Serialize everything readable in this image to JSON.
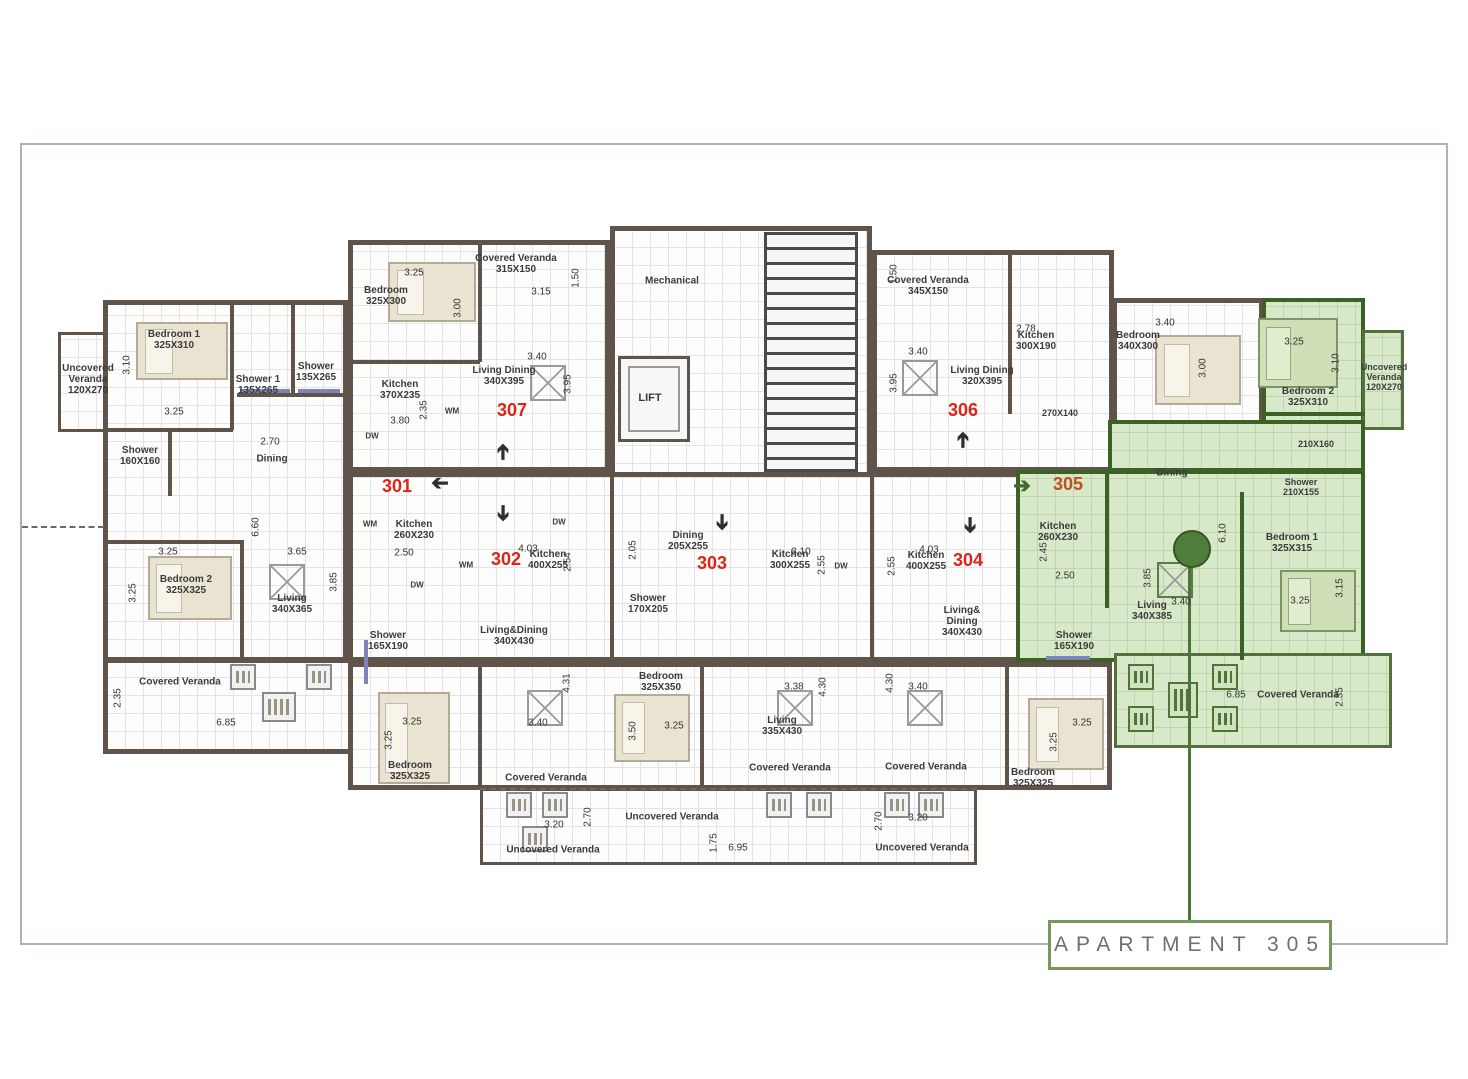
{
  "meta": {
    "drawing_type": "apartment floor plan",
    "highlighted_apartment": "305",
    "apartments_visible": [
      "301",
      "302",
      "303",
      "304",
      "305",
      "306",
      "307"
    ]
  },
  "colors": {
    "wall": "#60544a",
    "green_wall": "#3c6124",
    "green_fill": "#d8e9ca",
    "apartment_number_red": "#de2417",
    "apartment_number_305": "#bf4e20",
    "leader_green": "#4c7637",
    "frame": "#a9b6a8",
    "title_box_border": "#77975f",
    "title_box_text": "#6f6f6f"
  },
  "title_box": {
    "label": "APARTMENT 305"
  },
  "labels": [
    {
      "t": "Uncovered\nVeranda\n120X270",
      "x": 88,
      "y": 380,
      "k": "room"
    },
    {
      "t": "Bedroom 1\n325X310",
      "x": 174,
      "y": 340,
      "k": "room"
    },
    {
      "t": "Shower 1\n135X265",
      "x": 258,
      "y": 385,
      "k": "room"
    },
    {
      "t": "Shower\n135X265",
      "x": 316,
      "y": 372,
      "k": "room"
    },
    {
      "t": "Kitchen\n370X235",
      "x": 400,
      "y": 390,
      "k": "room"
    },
    {
      "t": "Shower\n160X160",
      "x": 140,
      "y": 456,
      "k": "room"
    },
    {
      "t": "Dining",
      "x": 272,
      "y": 459,
      "k": "room"
    },
    {
      "t": "Kitchen\n260X230",
      "x": 414,
      "y": 530,
      "k": "room"
    },
    {
      "t": "Living\n340X365",
      "x": 292,
      "y": 604,
      "k": "room"
    },
    {
      "t": "Bedroom 2\n325X325",
      "x": 186,
      "y": 585,
      "k": "room"
    },
    {
      "t": "Covered Veranda",
      "x": 180,
      "y": 682,
      "k": "room"
    },
    {
      "t": "Bedroom\n325X300",
      "x": 386,
      "y": 296,
      "k": "room"
    },
    {
      "t": "Covered Veranda\n315X150",
      "x": 516,
      "y": 264,
      "k": "room"
    },
    {
      "t": "Living Dining\n340X395",
      "x": 504,
      "y": 376,
      "k": "room"
    },
    {
      "t": "Mechanical",
      "x": 672,
      "y": 281,
      "k": "room"
    },
    {
      "t": "LIFT",
      "x": 650,
      "y": 398,
      "k": "room",
      "s": 11
    },
    {
      "t": "Covered Veranda\n345X150",
      "x": 928,
      "y": 286,
      "k": "room"
    },
    {
      "t": "Living Dining\n320X395",
      "x": 982,
      "y": 376,
      "k": "room"
    },
    {
      "t": "Kitchen\n300X190",
      "x": 1036,
      "y": 341,
      "k": "room"
    },
    {
      "t": "270X140",
      "x": 1060,
      "y": 413,
      "k": "room",
      "s": 9
    },
    {
      "t": "Bedroom\n340X300",
      "x": 1138,
      "y": 341,
      "k": "room"
    },
    {
      "t": "Bedroom 2\n325X310",
      "x": 1308,
      "y": 397,
      "k": "room"
    },
    {
      "t": "Uncovered\nVeranda\n120X270",
      "x": 1384,
      "y": 377,
      "k": "room",
      "s": 9
    },
    {
      "t": "210X160",
      "x": 1316,
      "y": 444,
      "k": "room",
      "s": 9
    },
    {
      "t": "Dining",
      "x": 1172,
      "y": 473,
      "k": "room"
    },
    {
      "t": "Shower\n210X155",
      "x": 1301,
      "y": 487,
      "k": "room",
      "s": 9
    },
    {
      "t": "Bedroom 1\n325X315",
      "x": 1292,
      "y": 543,
      "k": "room"
    },
    {
      "t": "Kitchen\n260X230",
      "x": 1058,
      "y": 532,
      "k": "room"
    },
    {
      "t": "Living\n340X385",
      "x": 1152,
      "y": 611,
      "k": "room"
    },
    {
      "t": "Covered Veranda",
      "x": 1298,
      "y": 695,
      "k": "room"
    },
    {
      "t": "Kitchen\n400X255",
      "x": 548,
      "y": 560,
      "k": "room"
    },
    {
      "t": "Living&Dining\n340X430",
      "x": 514,
      "y": 636,
      "k": "room"
    },
    {
      "t": "Shower\n165X190",
      "x": 388,
      "y": 641,
      "k": "room"
    },
    {
      "t": "Bedroom\n325X325",
      "x": 410,
      "y": 771,
      "k": "room"
    },
    {
      "t": "Covered Veranda",
      "x": 546,
      "y": 778,
      "k": "room"
    },
    {
      "t": "Uncovered Veranda",
      "x": 553,
      "y": 850,
      "k": "room"
    },
    {
      "t": "Dining\n205X255",
      "x": 688,
      "y": 541,
      "k": "room"
    },
    {
      "t": "Shower\n170X205",
      "x": 648,
      "y": 604,
      "k": "room"
    },
    {
      "t": "Bedroom\n325X350",
      "x": 661,
      "y": 682,
      "k": "room"
    },
    {
      "t": "Kitchen\n300X255",
      "x": 790,
      "y": 560,
      "k": "room"
    },
    {
      "t": "Living\n335X430",
      "x": 782,
      "y": 726,
      "k": "room"
    },
    {
      "t": "Covered Veranda",
      "x": 790,
      "y": 768,
      "k": "room"
    },
    {
      "t": "Uncovered Veranda",
      "x": 672,
      "y": 817,
      "k": "room"
    },
    {
      "t": "Kitchen\n400X255",
      "x": 926,
      "y": 561,
      "k": "room"
    },
    {
      "t": "Living&\nDining\n340X430",
      "x": 962,
      "y": 622,
      "k": "room"
    },
    {
      "t": "Shower\n165X190",
      "x": 1074,
      "y": 641,
      "k": "room"
    },
    {
      "t": "Bedroom\n325X325",
      "x": 1033,
      "y": 778,
      "k": "room"
    },
    {
      "t": "Covered Veranda",
      "x": 926,
      "y": 767,
      "k": "room"
    },
    {
      "t": "Uncovered Veranda",
      "x": 922,
      "y": 848,
      "k": "room"
    },
    {
      "t": "3.10",
      "x": 127,
      "y": 365,
      "k": "dim",
      "r": 1
    },
    {
      "t": "3.25",
      "x": 174,
      "y": 412,
      "k": "dim"
    },
    {
      "t": "3.80",
      "x": 400,
      "y": 421,
      "k": "dim"
    },
    {
      "t": "2.35",
      "x": 424,
      "y": 410,
      "k": "dim",
      "r": 1
    },
    {
      "t": "2.70",
      "x": 270,
      "y": 442,
      "k": "dim"
    },
    {
      "t": "2.50",
      "x": 404,
      "y": 553,
      "k": "dim"
    },
    {
      "t": "3.65",
      "x": 297,
      "y": 552,
      "k": "dim"
    },
    {
      "t": "6.60",
      "x": 256,
      "y": 527,
      "k": "dim",
      "r": 1
    },
    {
      "t": "3.85",
      "x": 334,
      "y": 582,
      "k": "dim",
      "r": 1
    },
    {
      "t": "3.25",
      "x": 133,
      "y": 593,
      "k": "dim",
      "r": 1
    },
    {
      "t": "3.25",
      "x": 168,
      "y": 552,
      "k": "dim"
    },
    {
      "t": "2.35",
      "x": 118,
      "y": 698,
      "k": "dim",
      "r": 1
    },
    {
      "t": "6.85",
      "x": 226,
      "y": 723,
      "k": "dim"
    },
    {
      "t": "3.25",
      "x": 414,
      "y": 273,
      "k": "dim"
    },
    {
      "t": "3.00",
      "x": 458,
      "y": 308,
      "k": "dim",
      "r": 1
    },
    {
      "t": "3.15",
      "x": 541,
      "y": 292,
      "k": "dim"
    },
    {
      "t": "1.50",
      "x": 576,
      "y": 278,
      "k": "dim",
      "r": 1
    },
    {
      "t": "3.40",
      "x": 537,
      "y": 357,
      "k": "dim"
    },
    {
      "t": "3.95",
      "x": 568,
      "y": 384,
      "k": "dim",
      "r": 1
    },
    {
      "t": "1.50",
      "x": 894,
      "y": 274,
      "k": "dim",
      "r": 1
    },
    {
      "t": "3.40",
      "x": 918,
      "y": 352,
      "k": "dim"
    },
    {
      "t": "3.95",
      "x": 894,
      "y": 383,
      "k": "dim",
      "r": 1
    },
    {
      "t": "2.78",
      "x": 1026,
      "y": 329,
      "k": "dim"
    },
    {
      "t": "3.40",
      "x": 1165,
      "y": 323,
      "k": "dim"
    },
    {
      "t": "3.00",
      "x": 1203,
      "y": 368,
      "k": "dim",
      "r": 1
    },
    {
      "t": "3.25",
      "x": 1294,
      "y": 342,
      "k": "dim"
    },
    {
      "t": "3.10",
      "x": 1336,
      "y": 363,
      "k": "dim",
      "r": 1
    },
    {
      "t": "6.10",
      "x": 1223,
      "y": 533,
      "k": "dim",
      "r": 1
    },
    {
      "t": "3.25",
      "x": 1300,
      "y": 601,
      "k": "dim"
    },
    {
      "t": "3.15",
      "x": 1340,
      "y": 588,
      "k": "dim",
      "r": 1
    },
    {
      "t": "2.45",
      "x": 1044,
      "y": 552,
      "k": "dim",
      "r": 1
    },
    {
      "t": "2.50",
      "x": 1065,
      "y": 576,
      "k": "dim"
    },
    {
      "t": "3.40",
      "x": 1181,
      "y": 602,
      "k": "dim"
    },
    {
      "t": "3.85",
      "x": 1148,
      "y": 578,
      "k": "dim",
      "r": 1
    },
    {
      "t": "6.85",
      "x": 1236,
      "y": 695,
      "k": "dim"
    },
    {
      "t": "2.35",
      "x": 1340,
      "y": 697,
      "k": "dim",
      "r": 1
    },
    {
      "t": "4.03",
      "x": 528,
      "y": 549,
      "k": "dim"
    },
    {
      "t": "2.54",
      "x": 568,
      "y": 562,
      "k": "dim",
      "r": 1
    },
    {
      "t": "4.31",
      "x": 567,
      "y": 683,
      "k": "dim",
      "r": 1
    },
    {
      "t": "3.40",
      "x": 538,
      "y": 723,
      "k": "dim"
    },
    {
      "t": "3.25",
      "x": 412,
      "y": 722,
      "k": "dim"
    },
    {
      "t": "3.25",
      "x": 389,
      "y": 740,
      "k": "dim",
      "r": 1
    },
    {
      "t": "3.20",
      "x": 554,
      "y": 825,
      "k": "dim"
    },
    {
      "t": "2.70",
      "x": 588,
      "y": 817,
      "k": "dim",
      "r": 1
    },
    {
      "t": "2.05",
      "x": 633,
      "y": 550,
      "k": "dim",
      "r": 1
    },
    {
      "t": "3.25",
      "x": 674,
      "y": 726,
      "k": "dim"
    },
    {
      "t": "3.50",
      "x": 633,
      "y": 731,
      "k": "dim",
      "r": 1
    },
    {
      "t": "3.10",
      "x": 801,
      "y": 552,
      "k": "dim"
    },
    {
      "t": "2.55",
      "x": 822,
      "y": 565,
      "k": "dim",
      "r": 1
    },
    {
      "t": "3.38",
      "x": 794,
      "y": 687,
      "k": "dim"
    },
    {
      "t": "4.30",
      "x": 823,
      "y": 687,
      "k": "dim",
      "r": 1
    },
    {
      "t": "4.03",
      "x": 929,
      "y": 550,
      "k": "dim"
    },
    {
      "t": "2.55",
      "x": 892,
      "y": 566,
      "k": "dim",
      "r": 1
    },
    {
      "t": "3.40",
      "x": 918,
      "y": 687,
      "k": "dim"
    },
    {
      "t": "4.30",
      "x": 890,
      "y": 683,
      "k": "dim",
      "r": 1
    },
    {
      "t": "3.25",
      "x": 1082,
      "y": 723,
      "k": "dim"
    },
    {
      "t": "3.25",
      "x": 1054,
      "y": 742,
      "k": "dim",
      "r": 1
    },
    {
      "t": "3.20",
      "x": 918,
      "y": 818,
      "k": "dim"
    },
    {
      "t": "2.70",
      "x": 879,
      "y": 821,
      "k": "dim",
      "r": 1
    },
    {
      "t": "1.75",
      "x": 714,
      "y": 843,
      "k": "dim",
      "r": 1
    },
    {
      "t": "6.95",
      "x": 738,
      "y": 848,
      "k": "dim"
    },
    {
      "t": "WM",
      "x": 370,
      "y": 525,
      "k": "room",
      "s": 8
    },
    {
      "t": "DW",
      "x": 417,
      "y": 586,
      "k": "room",
      "s": 8
    },
    {
      "t": "WM",
      "x": 452,
      "y": 412,
      "k": "room",
      "s": 8
    },
    {
      "t": "DW",
      "x": 372,
      "y": 437,
      "k": "room",
      "s": 8
    },
    {
      "t": "DW",
      "x": 559,
      "y": 523,
      "k": "room",
      "s": 8
    },
    {
      "t": "WM",
      "x": 466,
      "y": 566,
      "k": "room",
      "s": 8
    },
    {
      "t": "DW",
      "x": 841,
      "y": 567,
      "k": "room",
      "s": 8
    },
    {
      "t": "301",
      "x": 397,
      "y": 486,
      "k": "apt",
      "s": 18,
      "c": "#de2417"
    },
    {
      "t": "302",
      "x": 506,
      "y": 559,
      "k": "apt",
      "s": 18,
      "c": "#de2417"
    },
    {
      "t": "303",
      "x": 712,
      "y": 563,
      "k": "apt",
      "s": 18,
      "c": "#de2417"
    },
    {
      "t": "304",
      "x": 968,
      "y": 560,
      "k": "apt",
      "s": 18,
      "c": "#de2417"
    },
    {
      "t": "305",
      "x": 1068,
      "y": 484,
      "k": "apt",
      "s": 18,
      "c": "#bf4e20"
    },
    {
      "t": "306",
      "x": 963,
      "y": 410,
      "k": "apt",
      "s": 18,
      "c": "#de2417"
    },
    {
      "t": "307",
      "x": 512,
      "y": 410,
      "k": "apt",
      "s": 18,
      "c": "#de2417"
    }
  ],
  "arrows": [
    {
      "d": "left",
      "x": 440,
      "y": 483,
      "n": "entry-arrow-301"
    },
    {
      "d": "up",
      "x": 503,
      "y": 452,
      "n": "entry-arrow-307"
    },
    {
      "d": "down",
      "x": 503,
      "y": 513,
      "n": "entry-arrow-302"
    },
    {
      "d": "down",
      "x": 722,
      "y": 522,
      "n": "entry-arrow-303"
    },
    {
      "d": "down",
      "x": 970,
      "y": 525,
      "n": "entry-arrow-304"
    },
    {
      "d": "up",
      "x": 963,
      "y": 440,
      "n": "entry-arrow-306"
    },
    {
      "d": "right",
      "x": 1022,
      "y": 486,
      "n": "entry-arrow-305",
      "c": "#3f6b2e"
    }
  ]
}
